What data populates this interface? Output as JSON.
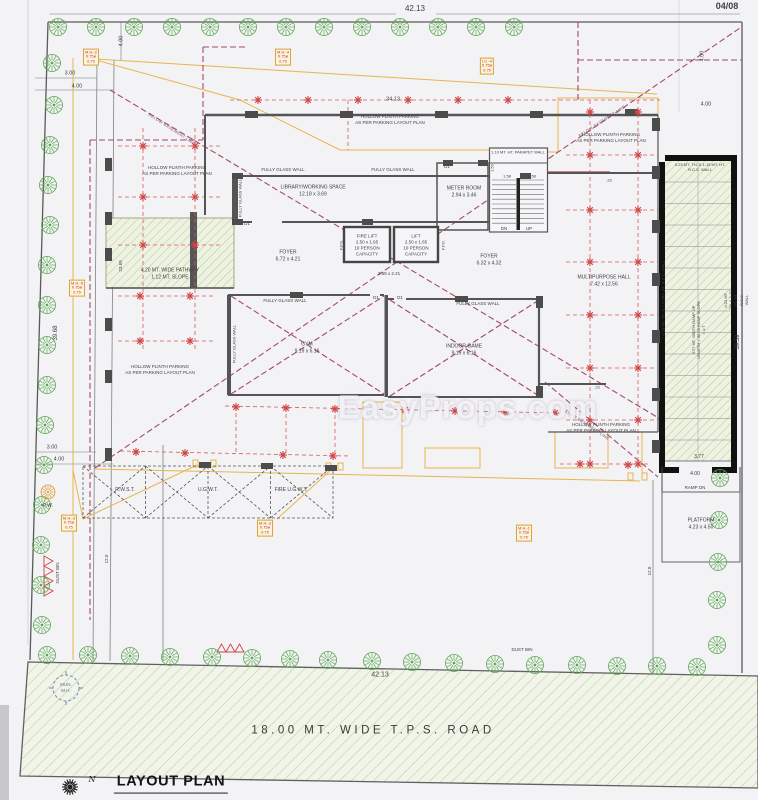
{
  "page": {
    "number": "04/08",
    "watermark": "EasyProps.com",
    "title": "LAYOUT PLAN",
    "north": "N"
  },
  "road": {
    "name": "18.00 MT. WIDE T.P.S. ROAD",
    "dim": "42.13",
    "manhole": "MUN.\nM.H.",
    "dust_bin": "DUST BIN"
  },
  "dims": {
    "top": "42.13",
    "left": "39.68",
    "right": "39.59",
    "building": "34.13",
    "offset3": "3.00",
    "offset4": "4.00",
    "top_left_v": "4.00",
    "top_right_v": "4.00",
    "top_right_h": "4.00",
    "bottom3": "3.00",
    "bottom4": "4.00",
    "left12": "12.0",
    "right12": "12.0",
    "pathway_len": "23.69",
    "stair_w1": "1.50",
    "stair_w2": "1.58",
    "stair_w3": "1.58",
    "wall23": ".23",
    "ramp_w": "3.77",
    "ramp_b": "4.00"
  },
  "rooms": {
    "library": "LIBRARY/WORKING SPACE\n12.18 x 3.69",
    "meter": "METER ROOM\n2.94 x 3.46",
    "fire_lift": "FIRE LIFT\n2.50 x 1.65\n10 PERSON\nCAPACITY",
    "lift": "LIFT\n2.50 x 1.65\n10 PERSON\nCAPACITY",
    "foyer_left": "FOYER\n6.72 x 4.21",
    "foyer_right": "FOYER\n6.32 x 4.32",
    "passage": "3.69 x 2.21",
    "gym": "GYM\n9.19 x 6.16",
    "indoor": "INDOOR GAME\n9.19 x 6.16",
    "hall": "MULTIPURPOSE HALL\n7.42 x 12.56",
    "platform": "PLATFORM\n4.23 x 4.50"
  },
  "labels": {
    "glass": "FULLY GLASS WALL",
    "parapet": "1.10 MT. HT. PARAPET WALL",
    "parking": "HOLLOW PLINTH PARKING\nAS PER PARKING LAYOUT PLAN",
    "basement": "BELOW BASEMENT LINE",
    "pathway": "4.20 MT. WIDE PATHWAY\n1.12 MT. SLOPE",
    "dn": "DN",
    "up": "UP",
    "door": "D1",
    "fps": "F.P.S.",
    "fpd": "F.P.D.",
    "ramp_dn": "RAMP DN",
    "rcc": "0.23 MT. TH. & 1.15 MT. HT.\nR.C.C. WALL",
    "rcc_side": "0.23 MT. TH. & 1.15 MT. HT. R.C.C. WALL",
    "ramp_spec": "3.77 MT. WIDTH RAMP UP\nLENGTH = 36.56 RAMP SLOPE = 1:7",
    "dust_bin": "DUST BIN",
    "pw": "P.W."
  },
  "tanks": {
    "rain": "R.W.S.T.",
    "underground": "U.G.W.T.",
    "fire": "FIRE U.G.W.T."
  },
  "manholes": [
    "M.H.-2\n0.75ø\n0.75",
    "M.H.-4\n0.75ø\n0.75",
    "I.C.-4\n0.75ø\n0.75",
    "M.H.-5\n0.75ø\n0.75",
    "M.H.-3\n0.75ø\n0.75",
    "M.H.-3\n0.75ø\n0.75",
    "M.H.-1\n0.75ø\n0.75"
  ]
}
